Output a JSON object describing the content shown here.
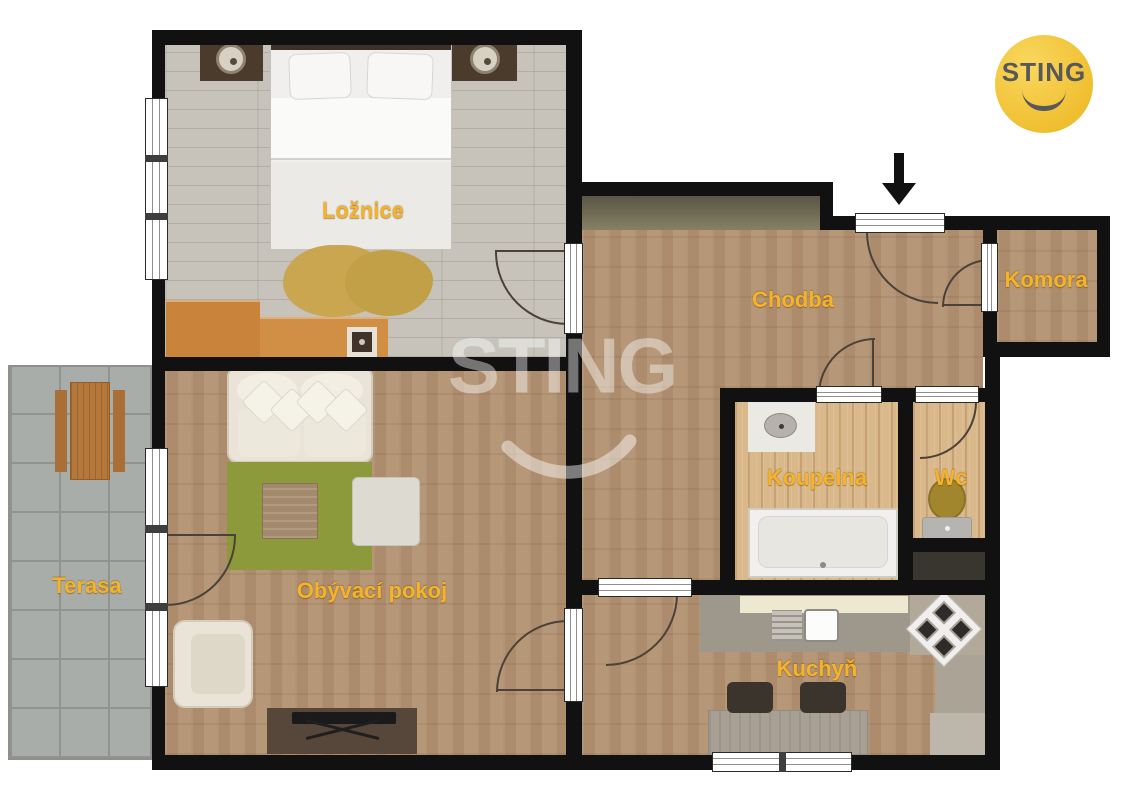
{
  "brand": {
    "logo_text": "STING"
  },
  "watermark": {
    "text": "STING"
  },
  "rooms": [
    {
      "id": "loznice",
      "label": "Ložnice"
    },
    {
      "id": "chodba",
      "label": "Chodba"
    },
    {
      "id": "komora",
      "label": "Komora"
    },
    {
      "id": "koupelna",
      "label": "Koupelna"
    },
    {
      "id": "wc",
      "label": "Wc"
    },
    {
      "id": "kuchyn",
      "label": "Kuchyň"
    },
    {
      "id": "obyvaci-pokoj",
      "label": "Obývací pokoj"
    },
    {
      "id": "terasa",
      "label": "Terasa"
    }
  ],
  "entry_marker": "arrow-down",
  "colors": {
    "wall": "#111111",
    "room_label": "#f3b42c",
    "logo_circle": "#f2c238",
    "logo_text": "#58585a",
    "parquet_floor": "#b29272",
    "bedroom_floor": "#c7c3bb",
    "bath_floor": "#d9b98c",
    "terrace_paving": "#a9ada9",
    "rug_green": "#8c9a3c",
    "rug_tan": "#c9a64f",
    "watermark": "rgba(255,255,255,0.42)"
  }
}
